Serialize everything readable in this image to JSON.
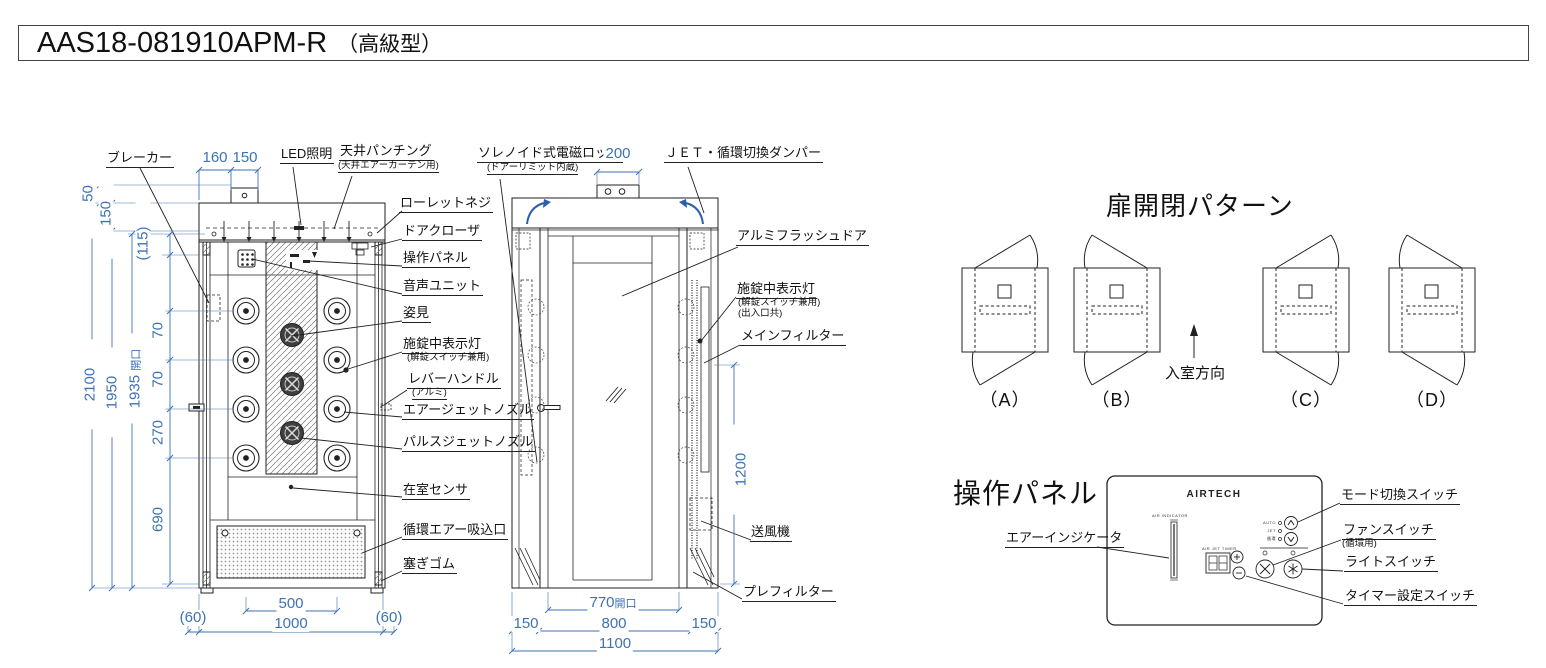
{
  "title": {
    "model": "AAS18-081910APM-R",
    "suffix": "（高級型）"
  },
  "front_view": {
    "dims": {
      "top_160": "160",
      "top_150": "150",
      "left_50": "50",
      "left_150": "150",
      "left_115": "(115)",
      "left_2100": "2100",
      "left_1950": "1950",
      "left_1935": "1935",
      "left_1935_suffix": "開口",
      "seg_270a": "270",
      "seg_270b": "270",
      "seg_270c": "270",
      "seg_690": "690",
      "bottom_60l": "(60)",
      "bottom_500": "500",
      "bottom_1000": "1000",
      "bottom_60r": "(60)"
    },
    "labels": {
      "breaker": "ブレーカー",
      "led": "LED照明",
      "ceiling_punching": "天井パンチング",
      "ceiling_punching_sub": "(天井エアーカーテン用)",
      "knurled_screw": "ローレットネジ",
      "door_closer": "ドアクローザ",
      "control_panel": "操作パネル",
      "voice_unit": "音声ユニット",
      "mirror": "姿見",
      "lock_lamp": "施錠中表示灯",
      "lock_lamp_sub": "(解錠スイッチ兼用)",
      "lever_handle": "レバーハンドル",
      "lever_handle_sub": "(アルミ)",
      "air_jet_nozzle": "エアージェットノズル",
      "pulse_jet_nozzle": "パルスジェットノズル",
      "occupancy_sensor": "在室センサ",
      "return_air_inlet": "循環エアー吸込口",
      "plug_rubber": "塞ぎゴム"
    }
  },
  "side_view": {
    "dims": {
      "top_200": "200",
      "right_1200": "1200",
      "bottom_770": "770",
      "bottom_770_suffix": "開口",
      "bottom_150l": "150",
      "bottom_800": "800",
      "bottom_150r": "150",
      "bottom_1100": "1100"
    },
    "labels": {
      "solenoid_lock": "ソレノイド式電磁ロック",
      "solenoid_lock_sub": "(ドアーリミット内蔵)",
      "damper": "ＪＥＴ・循環切換ダンパー",
      "aluminum_flush_door": "アルミフラッシュドア",
      "lock_lamp": "施錠中表示灯",
      "lock_lamp_sub1": "(解錠スイッチ兼用)",
      "lock_lamp_sub2": "(出入口共)",
      "main_filter": "メインフィルター",
      "blower": "送風機",
      "pre_filter": "プレフィルター"
    }
  },
  "door_patterns": {
    "heading": "扉開閉パターン",
    "entry_direction": "入室方向",
    "items": [
      {
        "label": "（A）"
      },
      {
        "label": "（B）"
      },
      {
        "label": "（C）"
      },
      {
        "label": "（D）"
      }
    ]
  },
  "control_panel": {
    "heading": "操作パネル",
    "brand": "AIRTECH",
    "air_indicator": "エアーインジケータ",
    "tiny": {
      "indicator": "AIR INDICATOR",
      "timer": "AIR JET TIMER",
      "mode_auto": "AUTO",
      "mode_jet": "JET",
      "mode_circ": "循環"
    },
    "labels": {
      "mode_switch": "モード切換スイッチ",
      "fan_switch": "ファンスイッチ",
      "fan_switch_sub": "(循環用)",
      "light_switch": "ライトスイッチ",
      "timer_switch": "タイマー設定スイッチ"
    }
  },
  "colors": {
    "dimension_blue": "#3d72b5",
    "arrow_blue": "#2b5fae",
    "line": "#222222"
  }
}
